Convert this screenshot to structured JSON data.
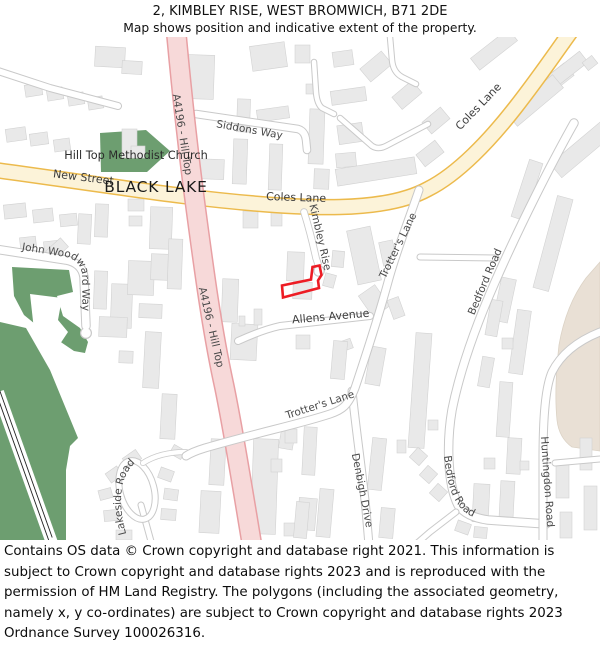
{
  "header": {
    "title": "2, KIMBLEY RISE, WEST BROMWICH, B71 2DE",
    "subtitle": "Map shows position and indicative extent of the property."
  },
  "footer": {
    "copyright": "Contains OS data © Crown copyright and database right 2021. This information is subject to Crown copyright and database rights 2023 and is reproduced with the permission of HM Land Registry. The polygons (including the associated geometry, namely x, y co-ordinates) are subject to Crown copyright and database rights 2023 Ordnance Survey 100026316."
  },
  "map": {
    "labels": {
      "a4196": "A4196 - Hill Top",
      "siddons_way": "Siddons Way",
      "new_street": "New Street",
      "black_lake": "BLACK LAKE",
      "church": "Hill Top Methodist Church",
      "coles_lane": "Coles Lane",
      "kimbley_rise": "Kimbley Rise",
      "trotters_lane": "Trotter's Lane",
      "john_woodward_way": "John Woodward Way",
      "allens_avenue": "Allens Avenue",
      "denbigh_drive": "Denbigh Drive",
      "bedford_road": "Bedford Road",
      "huntingdon_road": "Huntingdon Road",
      "lakeside_road": "Lakeside Road"
    },
    "colors": {
      "park": "#6d9e70",
      "road_primary_fill": "#f7d9d9",
      "road_primary_casing": "#e8a0a4",
      "road_secondary_fill": "#fcf3d9",
      "road_secondary_casing": "#ecba4c",
      "road_minor_fill": "#ffffff",
      "road_minor_casing": "#c9c9c9",
      "building_fill": "#e9e9e9",
      "building_stroke": "#d2d2d2",
      "landuse_beige": "#e9e0d5",
      "property_outline": "#ed1c24",
      "label": "#4a4a4a"
    }
  }
}
